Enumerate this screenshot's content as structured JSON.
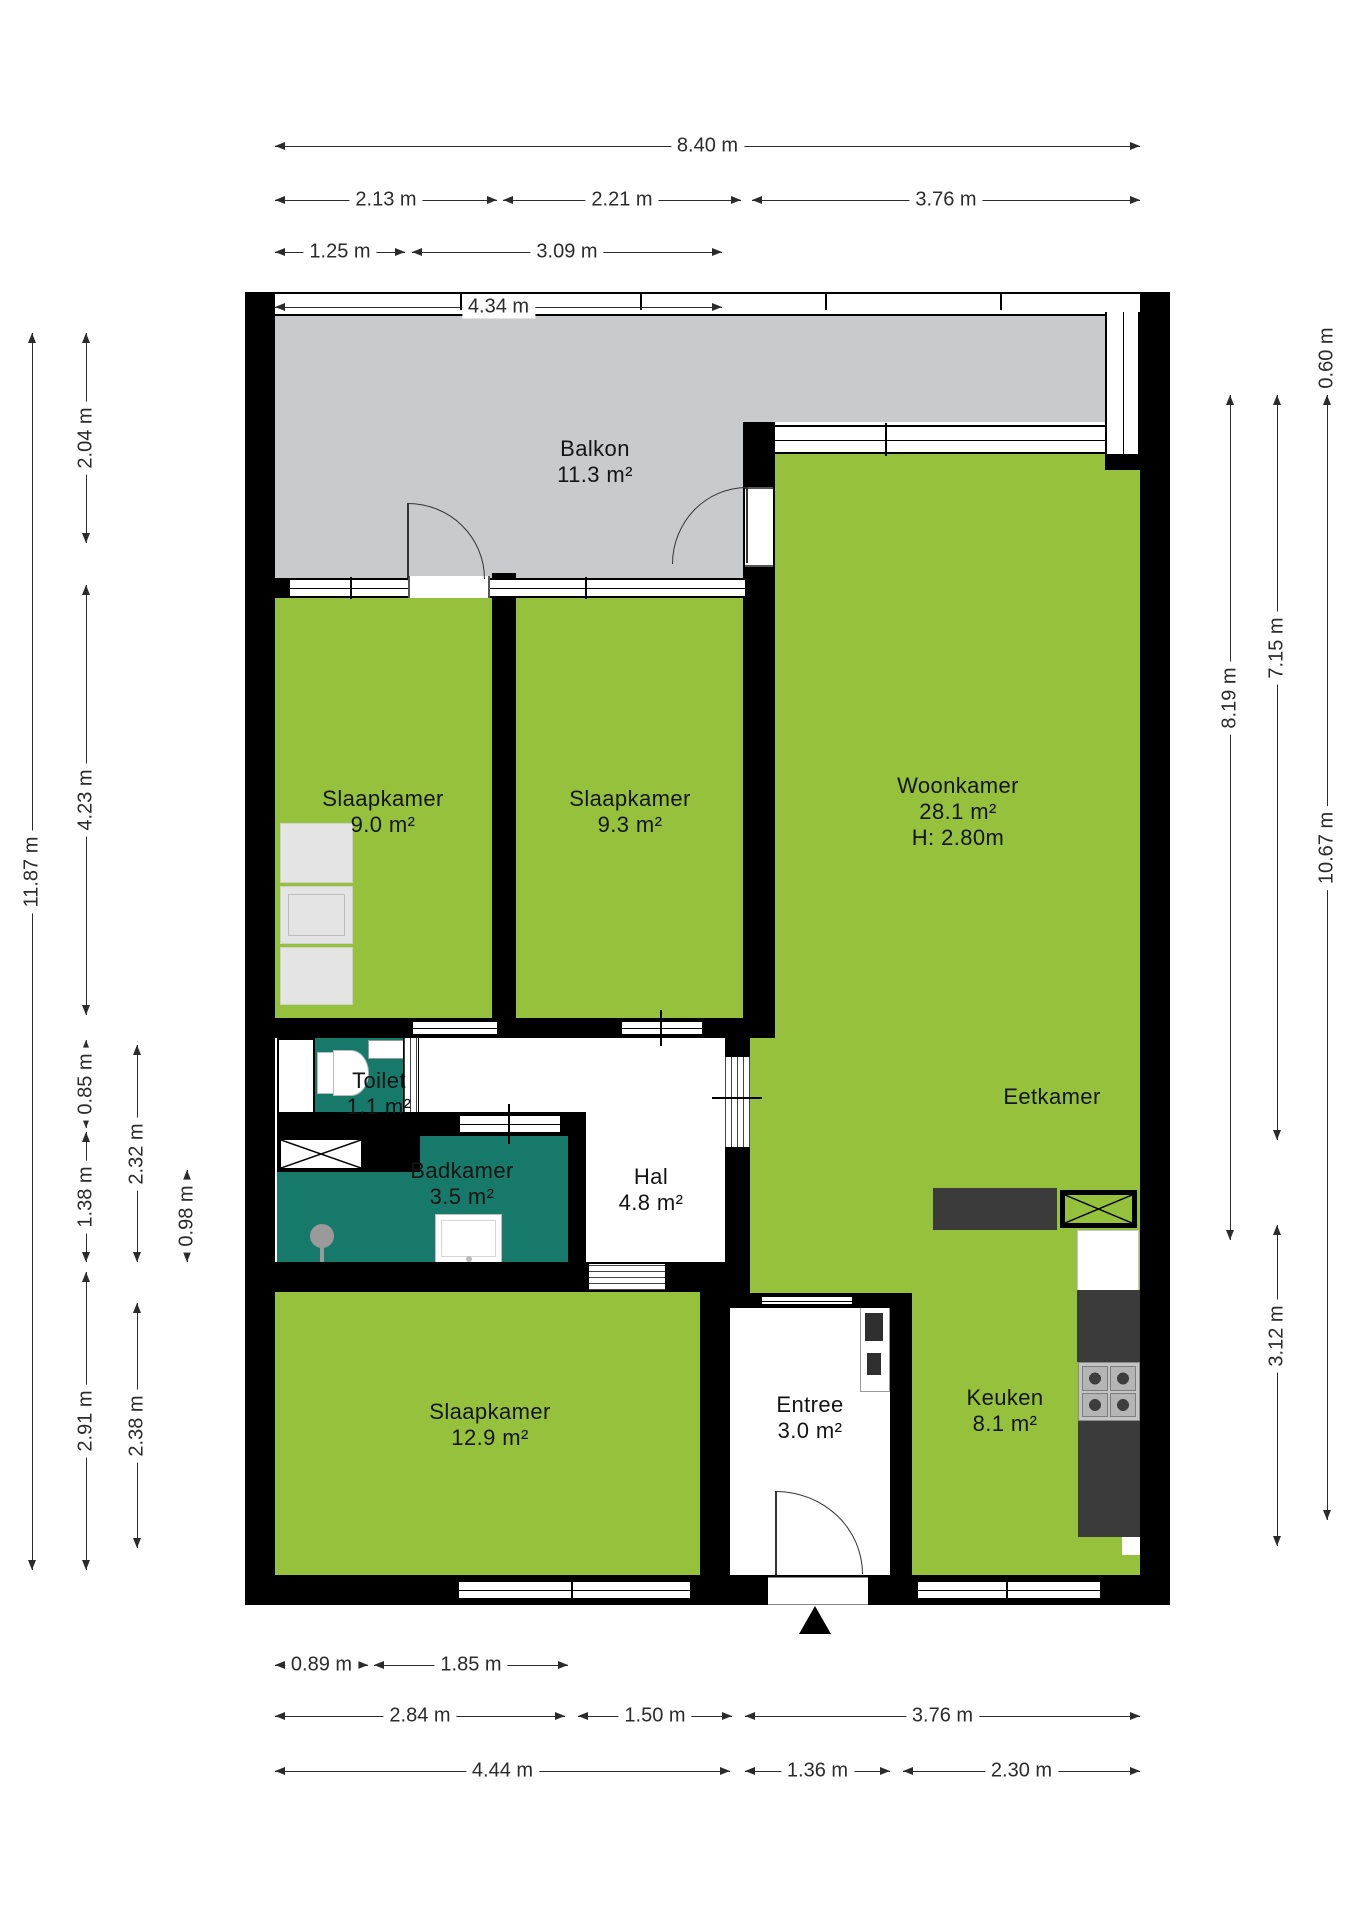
{
  "rooms": {
    "balkon": {
      "name": "Balkon",
      "area": "11.3 m²"
    },
    "slaapkamer1": {
      "name": "Slaapkamer",
      "area": "9.0 m²"
    },
    "slaapkamer2": {
      "name": "Slaapkamer",
      "area": "9.3 m²"
    },
    "woonkamer": {
      "name": "Woonkamer",
      "area": "28.1 m²",
      "height": "H: 2.80m"
    },
    "eetkamer": {
      "name": "Eetkamer"
    },
    "toilet": {
      "name": "Toilet",
      "area": "1.1 m²"
    },
    "badkamer": {
      "name": "Badkamer",
      "area": "3.5 m²"
    },
    "hal": {
      "name": "Hal",
      "area": "4.8 m²"
    },
    "slaapkamer3": {
      "name": "Slaapkamer",
      "area": "12.9 m²"
    },
    "entree": {
      "name": "Entree",
      "area": "3.0 m²"
    },
    "keuken": {
      "name": "Keuken",
      "area": "8.1 m²"
    }
  },
  "colors": {
    "room_green": "#95c13d",
    "wet_room_teal": "#17796a",
    "balcony_grey": "#c9cacb",
    "wall_black": "#000000",
    "counter_dark": "#3b3b3b"
  },
  "dimensions": [
    {
      "d": "h",
      "x": 275,
      "y": 146,
      "len": 865,
      "label": "8.40 m",
      "off": 0
    },
    {
      "d": "h",
      "x": 275,
      "y": 200,
      "len": 222,
      "label": "2.13 m",
      "off": 0
    },
    {
      "d": "h",
      "x": 503,
      "y": 200,
      "len": 238,
      "label": "2.21 m",
      "off": 0
    },
    {
      "d": "h",
      "x": 752,
      "y": 200,
      "len": 388,
      "label": "3.76 m",
      "off": 0
    },
    {
      "d": "h",
      "x": 275,
      "y": 252,
      "len": 130,
      "label": "1.25 m",
      "off": 0
    },
    {
      "d": "h",
      "x": 412,
      "y": 252,
      "len": 310,
      "label": "3.09 m",
      "off": 0
    },
    {
      "d": "h",
      "x": 275,
      "y": 307,
      "len": 447,
      "label": "4.34 m",
      "off": 0
    },
    {
      "d": "h",
      "x": 275,
      "y": 1665,
      "len": 93,
      "label": "0.89 m",
      "off": 0
    },
    {
      "d": "h",
      "x": 374,
      "y": 1665,
      "len": 194,
      "label": "1.85 m",
      "off": 0
    },
    {
      "d": "h",
      "x": 275,
      "y": 1716,
      "len": 290,
      "label": "2.84 m",
      "off": 0
    },
    {
      "d": "h",
      "x": 578,
      "y": 1716,
      "len": 154,
      "label": "1.50 m",
      "off": 0
    },
    {
      "d": "h",
      "x": 745,
      "y": 1716,
      "len": 395,
      "label": "3.76 m",
      "off": 0
    },
    {
      "d": "h",
      "x": 275,
      "y": 1771,
      "len": 455,
      "label": "4.44 m",
      "off": 0
    },
    {
      "d": "h",
      "x": 745,
      "y": 1771,
      "len": 145,
      "label": "1.36 m",
      "off": 0
    },
    {
      "d": "h",
      "x": 903,
      "y": 1771,
      "len": 237,
      "label": "2.30 m",
      "off": 0
    },
    {
      "d": "v",
      "x": 32,
      "y": 333,
      "len": 1237,
      "label": "11.87 m",
      "off": -80
    },
    {
      "d": "v",
      "x": 86,
      "y": 333,
      "len": 210,
      "label": "2.04 m",
      "off": 0
    },
    {
      "d": "v",
      "x": 86,
      "y": 585,
      "len": 430,
      "label": "4.23 m",
      "off": 0
    },
    {
      "d": "v",
      "x": 86,
      "y": 1040,
      "len": 88,
      "label": "0.85 m",
      "off": 0
    },
    {
      "d": "v",
      "x": 86,
      "y": 1132,
      "len": 130,
      "label": "1.38 m",
      "off": 0
    },
    {
      "d": "v",
      "x": 86,
      "y": 1272,
      "len": 298,
      "label": "2.91 m",
      "off": 0
    },
    {
      "d": "v",
      "x": 137,
      "y": 1045,
      "len": 217,
      "label": "2.32 m",
      "off": 0
    },
    {
      "d": "v",
      "x": 137,
      "y": 1303,
      "len": 245,
      "label": "2.38 m",
      "off": 0
    },
    {
      "d": "v",
      "x": 187,
      "y": 1170,
      "len": 92,
      "label": "0.98 m",
      "off": 0
    },
    {
      "d": "v",
      "x": 1230,
      "y": 395,
      "len": 845,
      "label": "8.19 m",
      "off": -120
    },
    {
      "d": "v",
      "x": 1277,
      "y": 395,
      "len": 745,
      "label": "7.15 m",
      "off": -120
    },
    {
      "d": "v",
      "x": 1277,
      "y": 1225,
      "len": 321,
      "label": "3.12 m",
      "off": -50
    },
    {
      "d": "v",
      "x": 1327,
      "y": 395,
      "len": 1125,
      "label": "10.67 m",
      "off": -110
    },
    {
      "d": "v",
      "x": 1327,
      "y": 326,
      "len": 64,
      "label": "0.60 m",
      "off": 0
    }
  ]
}
